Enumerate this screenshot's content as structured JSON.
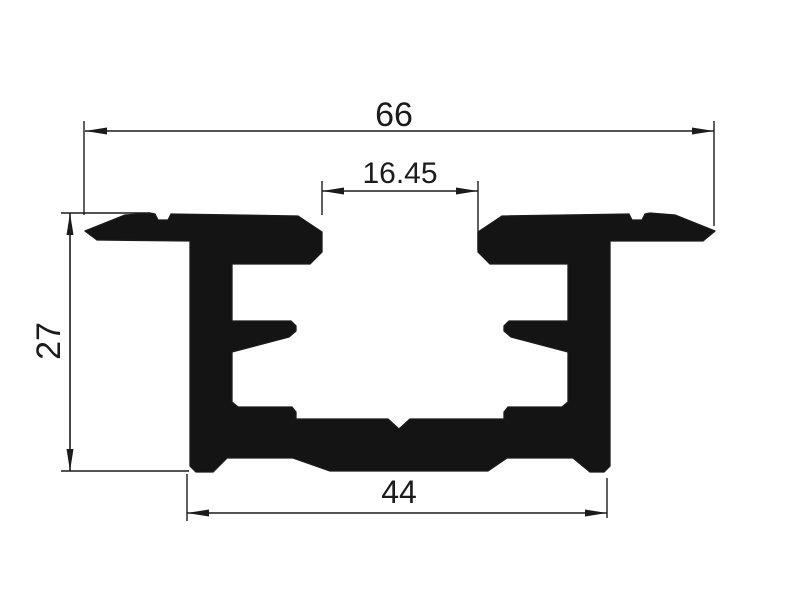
{
  "drawing": {
    "type": "technical-drawing",
    "subject": "aluminium extrusion profile cross-section",
    "background": "#ffffff",
    "ink": "#1b1b1b",
    "profile_fill": "#141414",
    "canvas": {
      "width": 800,
      "height": 600
    }
  },
  "profile": {
    "outline": [
      [
        85,
        231
      ],
      [
        125,
        215
      ],
      [
        150,
        213
      ],
      [
        155,
        214
      ],
      [
        158,
        220
      ],
      [
        168,
        220
      ],
      [
        171,
        214
      ],
      [
        298,
        216
      ],
      [
        322,
        232
      ],
      [
        322,
        252
      ],
      [
        310,
        264
      ],
      [
        232,
        264
      ],
      [
        232,
        321
      ],
      [
        291,
        321
      ],
      [
        296,
        326
      ],
      [
        296,
        331
      ],
      [
        289,
        337
      ],
      [
        232,
        352
      ],
      [
        232,
        402
      ],
      [
        238,
        407
      ],
      [
        292,
        407
      ],
      [
        296,
        412
      ],
      [
        296,
        419
      ],
      [
        388,
        419
      ],
      [
        399,
        429
      ],
      [
        410,
        419
      ],
      [
        504,
        419
      ],
      [
        504,
        412
      ],
      [
        508,
        407
      ],
      [
        562,
        407
      ],
      [
        568,
        402
      ],
      [
        568,
        352
      ],
      [
        511,
        337
      ],
      [
        504,
        331
      ],
      [
        504,
        326
      ],
      [
        509,
        321
      ],
      [
        568,
        321
      ],
      [
        568,
        264
      ],
      [
        490,
        264
      ],
      [
        478,
        252
      ],
      [
        478,
        232
      ],
      [
        502,
        216
      ],
      [
        629,
        214
      ],
      [
        632,
        220
      ],
      [
        642,
        220
      ],
      [
        645,
        214
      ],
      [
        650,
        213
      ],
      [
        675,
        215
      ],
      [
        715,
        231
      ],
      [
        703,
        241
      ],
      [
        610,
        241
      ],
      [
        610,
        466
      ],
      [
        604,
        472
      ],
      [
        590,
        472
      ],
      [
        573,
        458
      ],
      [
        507,
        458
      ],
      [
        488,
        471
      ],
      [
        330,
        471
      ],
      [
        293,
        458
      ],
      [
        227,
        458
      ],
      [
        213,
        472
      ],
      [
        196,
        472
      ],
      [
        190,
        466
      ],
      [
        190,
        241
      ],
      [
        97,
        240
      ]
    ]
  },
  "dimensions": {
    "top_width": {
      "label": "66",
      "line": [
        85,
        131,
        714,
        131
      ],
      "extensions": [
        [
          84,
          121,
          84,
          215
        ],
        [
          714,
          121,
          714,
          226
        ]
      ],
      "label_pos": [
        394,
        126
      ],
      "font_size": 34,
      "rotate": 0
    },
    "slot_width": {
      "label": "16.45",
      "line": [
        322,
        191,
        478,
        191
      ],
      "extensions": [
        [
          322,
          181,
          322,
          215
        ],
        [
          478,
          181,
          478,
          250
        ]
      ],
      "label_pos": [
        400,
        183
      ],
      "font_size": 30,
      "rotate": 0
    },
    "height": {
      "label": "27",
      "line": [
        70,
        213,
        70,
        471
      ],
      "extensions": [
        [
          61,
          213,
          150,
          213
        ],
        [
          61,
          471,
          189,
          471
        ]
      ],
      "label_pos": [
        60,
        341
      ],
      "font_size": 34,
      "rotate": -90
    },
    "base_width": {
      "label": "44",
      "line": [
        187,
        513,
        607,
        513
      ],
      "extensions": [
        [
          187,
          474,
          187,
          521
        ],
        [
          607,
          478,
          607,
          518
        ]
      ],
      "label_pos": [
        399,
        503
      ],
      "font_size": 32,
      "rotate": 0
    }
  }
}
